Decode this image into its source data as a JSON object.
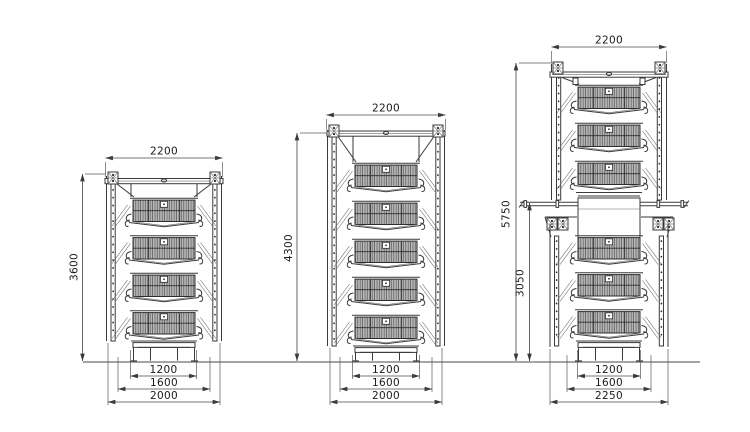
{
  "drawing": {
    "background": "#ffffff",
    "ink_color": "#3a3a3a",
    "dim_color": "#4a4a4a",
    "description": "technical-dimension-drawing-of-three-battery-layer-cage-systems"
  },
  "cages": [
    {
      "name": "four-tier-battery-cage",
      "tier_count": 4,
      "dims": {
        "top_width": "2200",
        "overall_height": "3600",
        "inner_width": "1200",
        "mid_width": "1600",
        "base_width": "2000"
      }
    },
    {
      "name": "five-tier-battery-cage",
      "tier_count": 5,
      "dims": {
        "top_width": "2200",
        "overall_height": "4300",
        "inner_width": "1200",
        "mid_width": "1600",
        "base_width": "2000"
      }
    },
    {
      "name": "stacked-h-frame-cage",
      "tiers_upper": 3,
      "tiers_lower": 3,
      "dims": {
        "top_width": "2200",
        "overall_height": "5750",
        "lower_height": "3050",
        "inner_width": "1200",
        "mid_width": "1600",
        "base_width": "2250"
      }
    }
  ]
}
